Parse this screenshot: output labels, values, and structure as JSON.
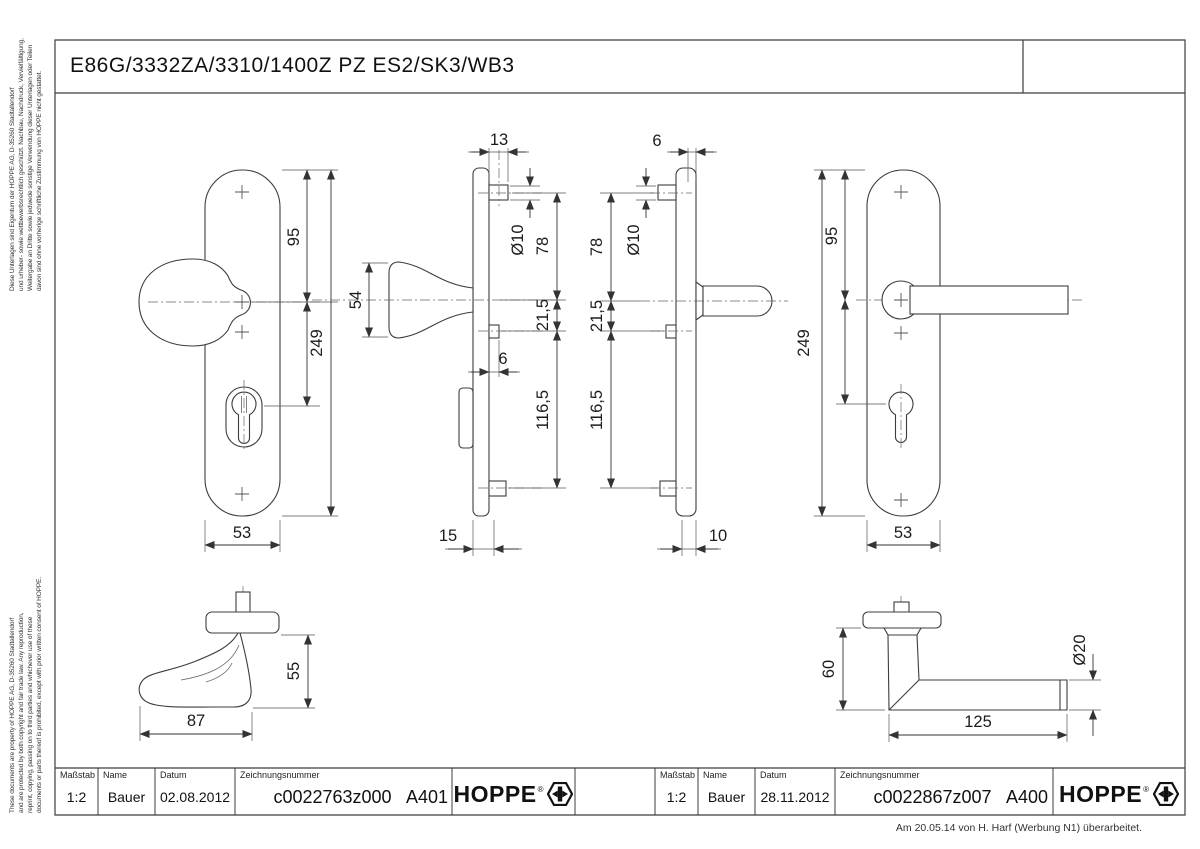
{
  "frame": {
    "title": "E86G/3332ZA/3310/1400Z PZ ES2/SK3/WB3"
  },
  "disclaimer_de": {
    "lines": [
      "Diese Unterlagen sind Eigentum der HOPPE AG, D-35260 Stadtallendorf",
      "und urheber- sowie wettbewerbsrechtlich geschützt. Nachbau, Nachdruck, Vervielfältigung,",
      "Weitergabe an Dritte sowie jedwede sonstige Verwendung dieser Unterlagen oder Teilen",
      "davon sind ohne vorherige schriftliche Zustimmung von HOPPE nicht gestattet."
    ]
  },
  "disclaimer_en": {
    "lines": [
      "These documents are property of HOPPE AG, D-35260 Stadtallendorf",
      "and are protected by both copyright and fair trade law. Any reproduction,",
      "reprint, copying, passing on to third parties and whichever use of these",
      "documents or parts thereof is prohibited, except with prior written consent of HOPPE."
    ]
  },
  "footer_note": "Am 20.05.14 von H. Harf (Werbung N1) überarbeitet.",
  "title_blocks": {
    "left": {
      "scale_label": "Maßstab",
      "scale_value": "1:2",
      "name_label": "Name",
      "name_value": "Bauer",
      "date_label": "Datum",
      "date_value": "02.08.2012",
      "number_label": "Zeichnungsnummer",
      "number_value": "c0022763z000",
      "sheet": "A401",
      "brand": "HOPPE",
      "brand_reg": "®"
    },
    "right": {
      "scale_label": "Maßstab",
      "scale_value": "1:2",
      "name_label": "Name",
      "name_value": "Bauer",
      "date_label": "Datum",
      "date_value": "28.11.2012",
      "number_label": "Zeichnungsnummer",
      "number_value": "c0022867z007",
      "sheet": "A400",
      "brand": "HOPPE",
      "brand_reg": "®"
    }
  },
  "views": {
    "knob_plate_front": {
      "dims": {
        "d95": "95",
        "d249": "249",
        "d53": "53"
      }
    },
    "knob_plate_side": {
      "dims": {
        "d13": "13",
        "d54": "54",
        "dia10": "Ø10",
        "d78": "78",
        "d21_5": "21,5",
        "d6": "6",
        "d116_5": "116,5",
        "d15": "15"
      }
    },
    "lever_plate_side": {
      "dims": {
        "d6": "6",
        "dia10": "Ø10",
        "d78": "78",
        "d21_5": "21,5",
        "d116_5": "116,5",
        "d10": "10"
      }
    },
    "lever_plate_front": {
      "dims": {
        "d95": "95",
        "d249": "249",
        "d53": "53"
      }
    },
    "knob_handle": {
      "dims": {
        "d55": "55",
        "d87": "87"
      }
    },
    "lever_handle": {
      "dims": {
        "d60": "60",
        "dia20": "Ø20",
        "d125": "125"
      }
    }
  },
  "colors": {
    "line": "#3c3c3c",
    "text": "#1a1a1a",
    "background": "#ffffff"
  }
}
